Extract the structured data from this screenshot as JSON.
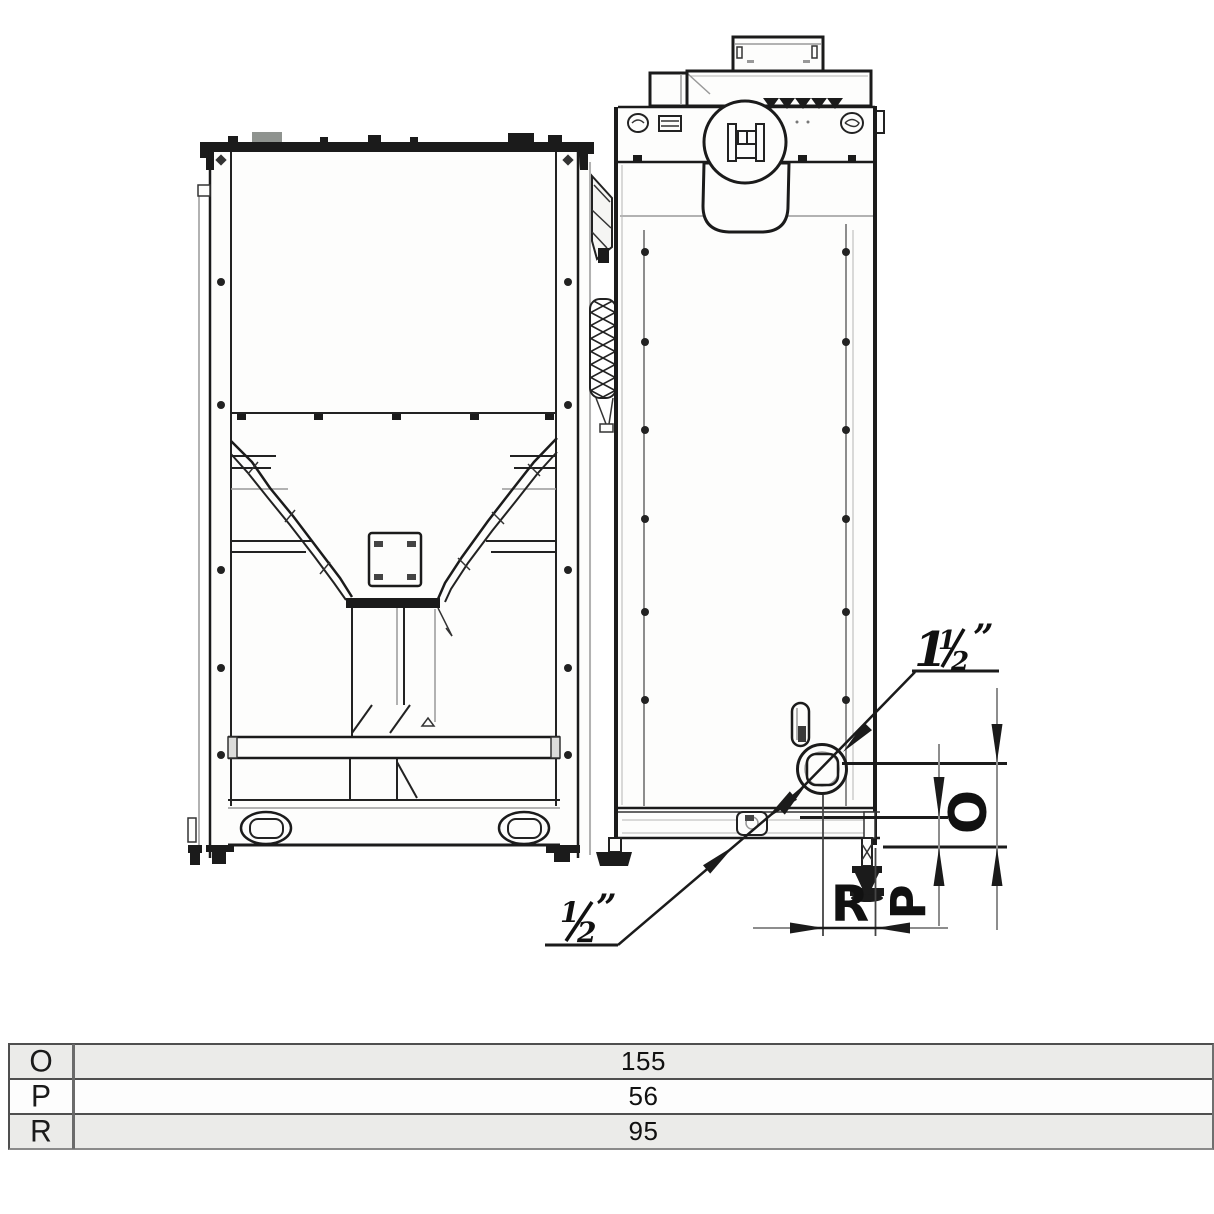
{
  "page": {
    "background": "#ffffff",
    "description": "Technical dimension drawing: pellet hopper rear view and boiler side view with connection dimensions"
  },
  "colors": {
    "ink": "#1b1b1b",
    "soft_gray": "#8d8d8d",
    "table_alt_row": "#ebebe9",
    "table_border": "#4f4f4f"
  },
  "callouts": {
    "pipe_1_5_inch": {
      "whole": "1",
      "frac_num": "1",
      "frac_den": "2",
      "quote": "”"
    },
    "pipe_0_5_inch": {
      "frac_num": "1",
      "frac_den": "2",
      "quote": "”"
    }
  },
  "dim_labels": {
    "o": "O",
    "p": "P",
    "r": "R"
  },
  "dim_table": {
    "rows": [
      {
        "label": "O",
        "value": "155"
      },
      {
        "label": "P",
        "value": "56"
      },
      {
        "label": "R",
        "value": "95"
      }
    ]
  }
}
